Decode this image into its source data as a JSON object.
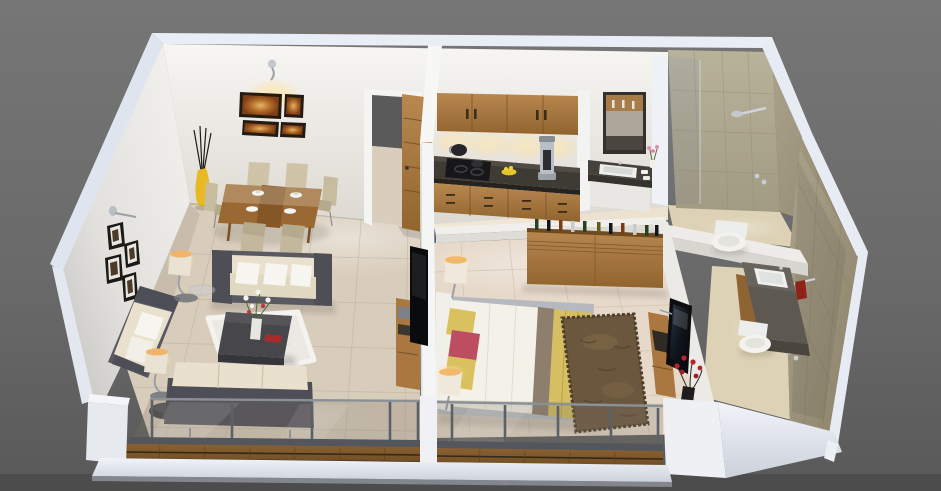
{
  "scene": {
    "title": "3D isometric cutaway render of a one-bedroom apartment floor plan",
    "style": "photorealistic 3D dollhouse view on gray background",
    "view": "bird's-eye perspective, walls cut at waist height"
  },
  "palette": {
    "bgTop": "#757575",
    "bgMid": "#696969",
    "bgBottom": "#5a5a5a",
    "bgStrip": "#4d4d4d",
    "wallCap": "#e9eef6",
    "wallFace": "#f2f1ee",
    "wallShade": "#c9c7c3",
    "floorWarm": "#d8ccba",
    "floorPale": "#efe6d5",
    "floorBed": "#e6d9ca",
    "floorBath": "#ddd2b5",
    "grout": "#bdb19d",
    "tile": "#b3ac94",
    "tileShade": "#a09978",
    "wood": "#a9773f",
    "woodDark": "#7c5526",
    "deck": "#7c5527",
    "deckGap": "#34281a",
    "rail": "#5c6168",
    "railLight": "#8b9097",
    "glassTint": "#7a7264",
    "sofaFrame": "#595962",
    "cushion": "#e9e1cd",
    "pillowWhite": "#f7f5f0",
    "rugWhite": "#ebe9e3",
    "rugBrown": "#6b573e",
    "tableDark": "#47474b",
    "granite": "#3e3a34",
    "vanityGray": "#5d5951",
    "toiletWhite": "#f3f2ee",
    "chrome": "#c7ccd2",
    "screenDark": "#0c0d10",
    "artOrange": "#b06a28",
    "frameDark": "#241a10",
    "accentYellow": "#d9c160",
    "accentPink": "#bd4d61",
    "blanketYellow": "#d5bf62",
    "throwTaupe": "#8d7e6e",
    "vaseYellow": "#e8b923",
    "flowerRed": "#b32330",
    "lampGlow": "#f3bf72",
    "doorWood": "#9c6a33"
  },
  "rooms": [
    {
      "id": "living-dining",
      "name": "Living and dining room",
      "items": [
        "three-seat sofa with white pillows",
        "two-seat sofa",
        "rear loveseat",
        "dark coffee table with flower vase",
        "white shag rug",
        "two floor lamps",
        "glass side table",
        "dark pouf",
        "dining table for six with beige chairs",
        "white plates",
        "yellow floor vase with twigs",
        "four orange framed artworks",
        "wall sconce",
        "four small framed photos",
        "wall-mounted TV",
        "wooden TV cabinet"
      ]
    },
    {
      "id": "kitchen",
      "name": "Kitchen",
      "items": [
        "upper wooden cabinets",
        "under-cabinet cove lights",
        "granite countertop",
        "black cooktop with pots",
        "coffee maker",
        "yellow fruit bowl",
        "wooden drawer units",
        "open wooden entry door"
      ]
    },
    {
      "id": "wash-nook",
      "name": "Wash basin nook",
      "items": [
        "dark framed mirror",
        "granite vanity with white basin",
        "pink flowers",
        "towels",
        "white under-cabinet"
      ]
    },
    {
      "id": "bathroom-common",
      "name": "Common bathroom",
      "items": [
        "glass partition",
        "wall shower with chrome head",
        "white toilet",
        "olive tiled walls"
      ]
    },
    {
      "id": "bathroom-attached",
      "name": "Attached bathroom",
      "items": [
        "granite vanity with white basin",
        "wooden vanity cabinet",
        "white toilet",
        "shower mixer",
        "red towel on rail",
        "tiled walls with glass panel"
      ]
    },
    {
      "id": "bedroom",
      "name": "Bedroom",
      "items": [
        "double bed with white linen",
        "yellow throw blanket",
        "yellow and pink pillows",
        "two glowing bedside lamps",
        "brown shag rug",
        "wooden bar sideboard with bottles",
        "wall-mounted TV",
        "wooden TV console",
        "red flower arrangement"
      ]
    },
    {
      "id": "balcony",
      "name": "Balcony",
      "items": [
        "wooden plank deck",
        "glass balustrade",
        "gray metal rails and posts",
        "white parapet ledge"
      ]
    }
  ]
}
